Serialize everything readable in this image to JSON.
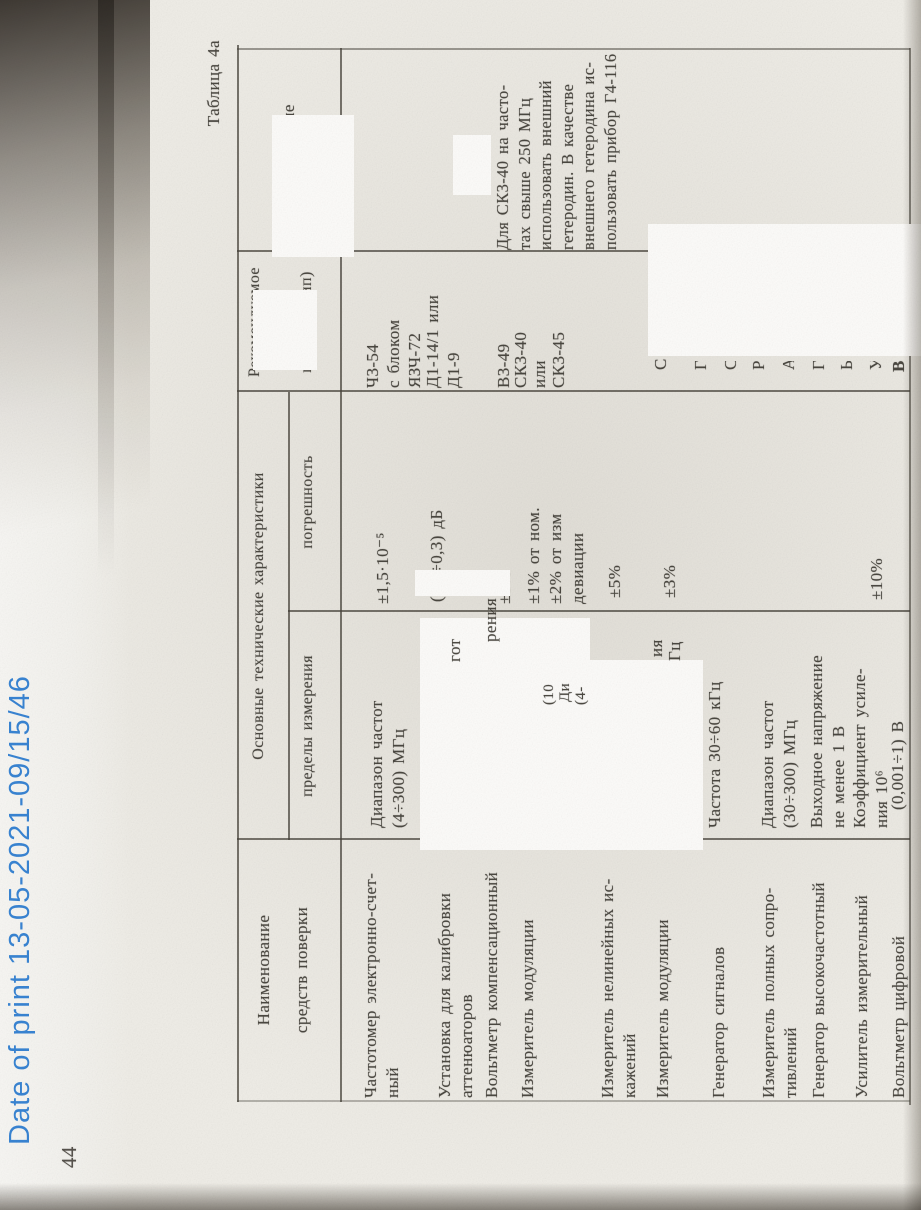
{
  "stamp": {
    "text": "Date of print 13-05-2021-09/15/46",
    "color": "#2f7fd2"
  },
  "page": {
    "number": "44"
  },
  "table": {
    "caption": "Таблица 4а",
    "headers": {
      "name_l1": "Наименование",
      "name_l2": "средств поверки",
      "group": "Основные технические характеристики",
      "sub_limits": "пределы измерения",
      "sub_error": "погрешность",
      "rec_l1": "Рекомендуемое",
      "rec_l2": "средство",
      "rec_l3": "поверки (тип)",
      "note": "Примечание"
    },
    "rows": [
      {
        "name": [
          "Частотомер электронно-счет-",
          "ный"
        ],
        "limits": [
          "Диапазон частот",
          "(4÷300) МГц"
        ],
        "error": [
          "±1,5·10⁻⁵"
        ],
        "rec": [
          "Ч3-54",
          "с блоком",
          "ЯЗЧ-72"
        ]
      },
      {
        "name": [
          "Установка для калибровки",
          "аттенюаторов"
        ],
        "error": [
          "(0,1÷0,3) дБ"
        ],
        "rec": [
          "Д1-14/1 или",
          "Д1-9"
        ]
      },
      {
        "name": [
          "Вольтметр компенсационный"
        ],
        "error": [
          "±3%"
        ],
        "rec": [
          "В3-49"
        ]
      },
      {
        "name": [
          "Измеритель модуляции"
        ],
        "error": [
          "±1% от ном.",
          "±2% от изм",
          "девиации"
        ],
        "rec": [
          "СК3-40",
          "или",
          "СК3-45"
        ]
      },
      {
        "name": [
          "Измеритель нелинейных ис-",
          "кажений"
        ],
        "error": [
          "±5%"
        ],
        "rec": [
          "С6-7"
        ]
      },
      {
        "name": [
          "Измеритель модуляции"
        ],
        "error": [
          "±3%"
        ]
      },
      {
        "name": [
          "Генератор сигналов"
        ],
        "limits": [
          "Частота 30÷60 кГц"
        ]
      },
      {
        "name": [
          "Измеритель полных сопро-",
          "тивлений"
        ],
        "limits": [
          "Диапазон частот",
          "(30÷300) МГц"
        ]
      },
      {
        "name": [
          "Генератор высокочастотный"
        ],
        "limits": [
          "Выходное напряжение",
          "не менее 1 В"
        ]
      },
      {
        "name": [
          "Усилитель измерительный"
        ],
        "limits": [
          "Коэффициент усиле-",
          "ния 10⁶"
        ],
        "error": [
          "±10%"
        ]
      },
      {
        "name": [
          "Вольтметр цифровой"
        ],
        "limits": [
          "(0,001÷1) В"
        ]
      }
    ],
    "note_text": [
      "Для  СК3-40  на часто-",
      "тах  свыше  250  МГц",
      "использовать  внешний",
      "гетеродин.  В качестве",
      "внешнего гетеродина ис-",
      "пользовать прибор Г4-116"
    ],
    "fragments": [
      "гот",
      "рения",
      "(10",
      "Ди",
      "(4-",
      "ия",
      "Гц",
      "С",
      "Г",
      "С",
      "Р",
      "А",
      "Г",
      "Ь",
      "У",
      "В"
    ]
  }
}
